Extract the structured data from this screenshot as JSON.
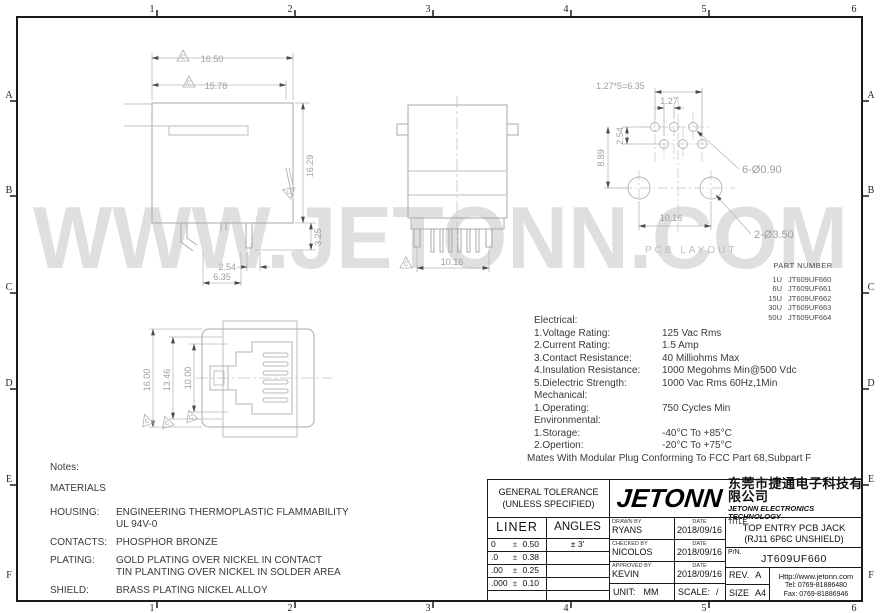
{
  "rulers": {
    "cols": [
      "1",
      "2",
      "3",
      "4",
      "5",
      "6"
    ],
    "rows": [
      "A",
      "B",
      "C",
      "D",
      "E",
      "F"
    ]
  },
  "watermark": "WWW.JETONN.COM",
  "rev_flag": "C",
  "colors": {
    "line_gray": "#aaaaaa",
    "dim_gray": "#9e9e9e",
    "ink": "#1a1a1a",
    "watermark_gray": "#d9d9d9"
  },
  "views": {
    "side": {
      "dim_w1": "16.50",
      "dim_w2": "15.78",
      "dim_h": "16.29",
      "dim_pin": "3.25",
      "dim_pitch": "2.54",
      "dim_span": "6.35"
    },
    "front": {
      "dim_span": "10.16"
    },
    "face": {
      "dim_h1": "16.00",
      "dim_h2": "13.46",
      "dim_h3": "10.00"
    },
    "pcb": {
      "title": "PCB LAYOUT",
      "dim_eq": "1.27*5=6.35",
      "dim_off": "1.27",
      "dim_row": "2.54",
      "dim_h": "8.89",
      "dim_span": "10.16",
      "callout_small": "6-Ø0.90",
      "callout_large": "2-Ø3.50"
    }
  },
  "part_number": {
    "title": "PART NUMBER",
    "rows": [
      {
        "qty": "1U",
        "pn": "JT609UF660"
      },
      {
        "qty": "6U",
        "pn": "JT609UF661"
      },
      {
        "qty": "15U",
        "pn": "JT609UF662"
      },
      {
        "qty": "30U",
        "pn": "JT609UF663"
      },
      {
        "qty": "50U",
        "pn": "JT609UF664"
      }
    ]
  },
  "specs": {
    "electrical_title": "Electrical:",
    "electrical": [
      {
        "label": "1.Voltage Rating:",
        "value": "125 Vac Rms"
      },
      {
        "label": "2.Current Rating:",
        "value": "1.5 Amp"
      },
      {
        "label": "3.Contact Resistance:",
        "value": "40 Milliohms Max"
      },
      {
        "label": "4.Insulation Resistance:",
        "value": "1000 Megohms Min@500 Vdc"
      },
      {
        "label": "5.Dielectric Strength:",
        "value": "1000 Vac Rms 60Hz,1Min"
      }
    ],
    "mechanical_title": "Mechanical:",
    "mechanical": [
      {
        "label": "1.Operating:",
        "value": "750 Cycles Min"
      }
    ],
    "environmental_title": "Environmental:",
    "environmental": [
      {
        "label": "1.Storage:",
        "value": "-40°C To +85°C"
      },
      {
        "label": "2.Opertion:",
        "value": "-20°C To +75°C"
      }
    ],
    "footnote": "Mates With Modular Plug Conforming To FCC Part 68,Subpart F"
  },
  "notes": {
    "title": "Notes:",
    "materials": "MATERIALS",
    "items": [
      {
        "label": "HOUSING:",
        "line1": "ENGINEERING THERMOPLASTIC FLAMMABILITY",
        "line2": "UL 94V-0"
      },
      {
        "label": "CONTACTS:",
        "line1": "PHOSPHOR BRONZE",
        "line2": ""
      },
      {
        "label": "PLATING:",
        "line1": "GOLD PLATING OVER NICKEL IN CONTACT",
        "line2": "TIN PLANTING OVER NICKEL IN SOLDER AREA"
      },
      {
        "label": "SHIELD:",
        "line1": "BRASS PLATING NICKEL ALLOY",
        "line2": ""
      }
    ]
  },
  "title_block": {
    "tol_title1": "GENERAL TOLERANCE",
    "tol_title2": "(UNLESS SPECIFIED)",
    "liner": "LINER",
    "angles": "ANGLES",
    "pm": "±",
    "angles_val": "3'",
    "liner_rows": [
      {
        "l": "0",
        "r": "0.50"
      },
      {
        "l": ".0",
        "r": "0.38"
      },
      {
        "l": ".00",
        "r": "0.25"
      },
      {
        "l": ".000",
        "r": "0.10"
      }
    ],
    "logo": "JETONN",
    "company_cn": "东莞市捷通电子科技有限公司",
    "company_en": "JETONN ELECTRONICS TECHNOLOGY",
    "drawn_label": "DRAWN BY",
    "drawn": "RYANS",
    "date_label": "DATE",
    "drawn_date": "2018/09/16",
    "checked_label": "CHECKED BY",
    "checked": "NICOLOS",
    "checked_date": "2018/09/16",
    "approved_label": "APPROVED BY",
    "approved": "KEVIN",
    "approved_date": "2018/09/16",
    "unit_label": "UNIT:",
    "unit": "MM",
    "scale_label": "SCALE:",
    "scale": "/",
    "title_label": "TITLE.",
    "title1": "TOP ENTRY PCB JACK",
    "title2": "(RJ11 6P6C UNSHIELD)",
    "pn_label": "P/N.",
    "pn": "JT609UF660",
    "rev_label": "REV.",
    "rev": "A",
    "size_label": "SIZE",
    "size": "A4",
    "website": "Http://www.jetonn.com",
    "tel": "Tel:  0769-81886480",
    "fax": "Fax:  0769-81886946"
  }
}
